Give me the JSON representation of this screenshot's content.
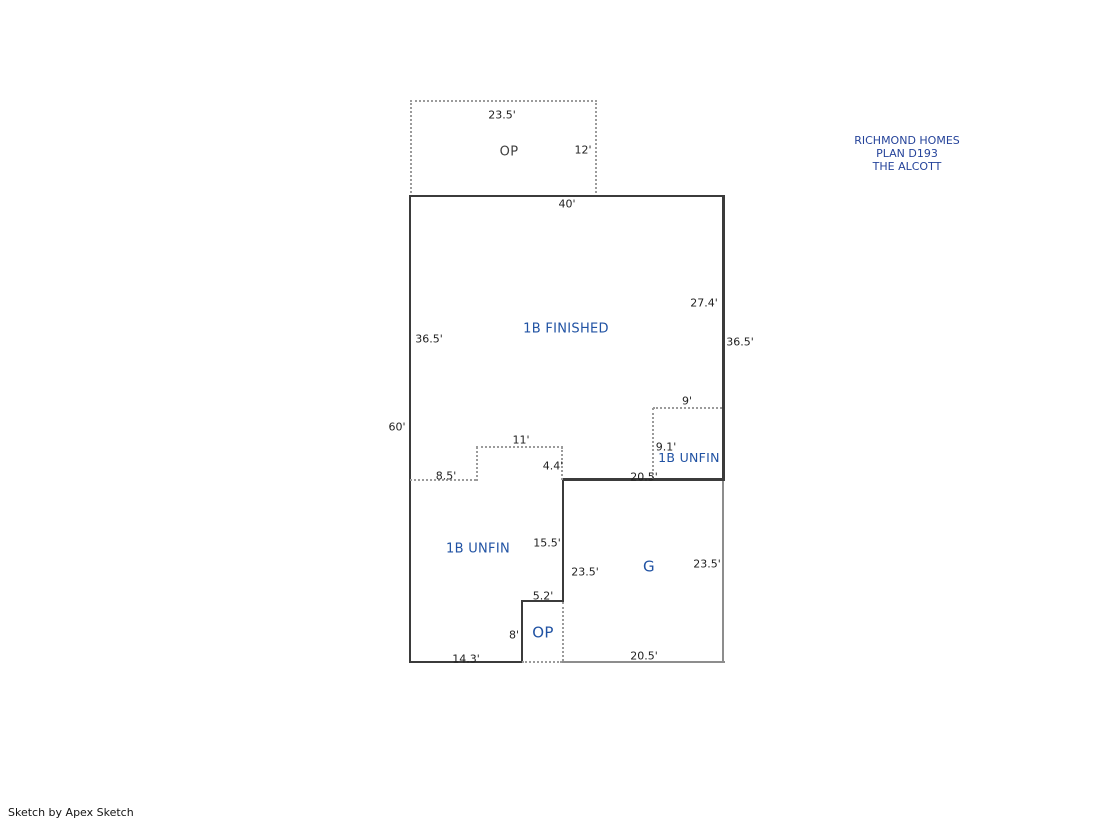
{
  "header": {
    "title_lines": [
      "RICHMOND HOMES",
      "PLAN D193",
      "THE ALCOTT"
    ]
  },
  "footer": {
    "credit": "Sketch by Apex Sketch"
  },
  "colors": {
    "area_label": "#2052a3",
    "dark_label": "#3f3f3f",
    "dimension_text": "#1f1f1f",
    "wall": "#3b3b3b",
    "gray_wall": "#8d8d8d",
    "dashed_line": "#9b9b9b",
    "title_text": "#25439a",
    "bg": "#ffffff"
  },
  "plan": {
    "areas": {
      "op_top": "OP",
      "finished": "1B FINISHED",
      "unfin_right": "1B UNFIN",
      "unfin_left": "1B UNFIN",
      "garage": "G",
      "op_bottom": "OP"
    },
    "dimensions": {
      "op_top_width": "23.5'",
      "op_top_height": "12'",
      "main_top_width": "40'",
      "right_upper": "27.4'",
      "left_upper": "36.5'",
      "right_full": "36.5'",
      "left_total": "60'",
      "unfin_right_width": "9'",
      "unfin_right_height": "9.1'",
      "step_left": "8.5'",
      "step_top": "11'",
      "step_right": "4.4'",
      "garage_top": "20.5'",
      "unfin_left_height": "15.5'",
      "garage_left_height": "23.5'",
      "garage_right_height": "23.5'",
      "op_bottom_top": "5.2'",
      "op_bottom_left": "8'",
      "bottom_left_width": "14.3'",
      "garage_bottom": "20.5'"
    }
  }
}
